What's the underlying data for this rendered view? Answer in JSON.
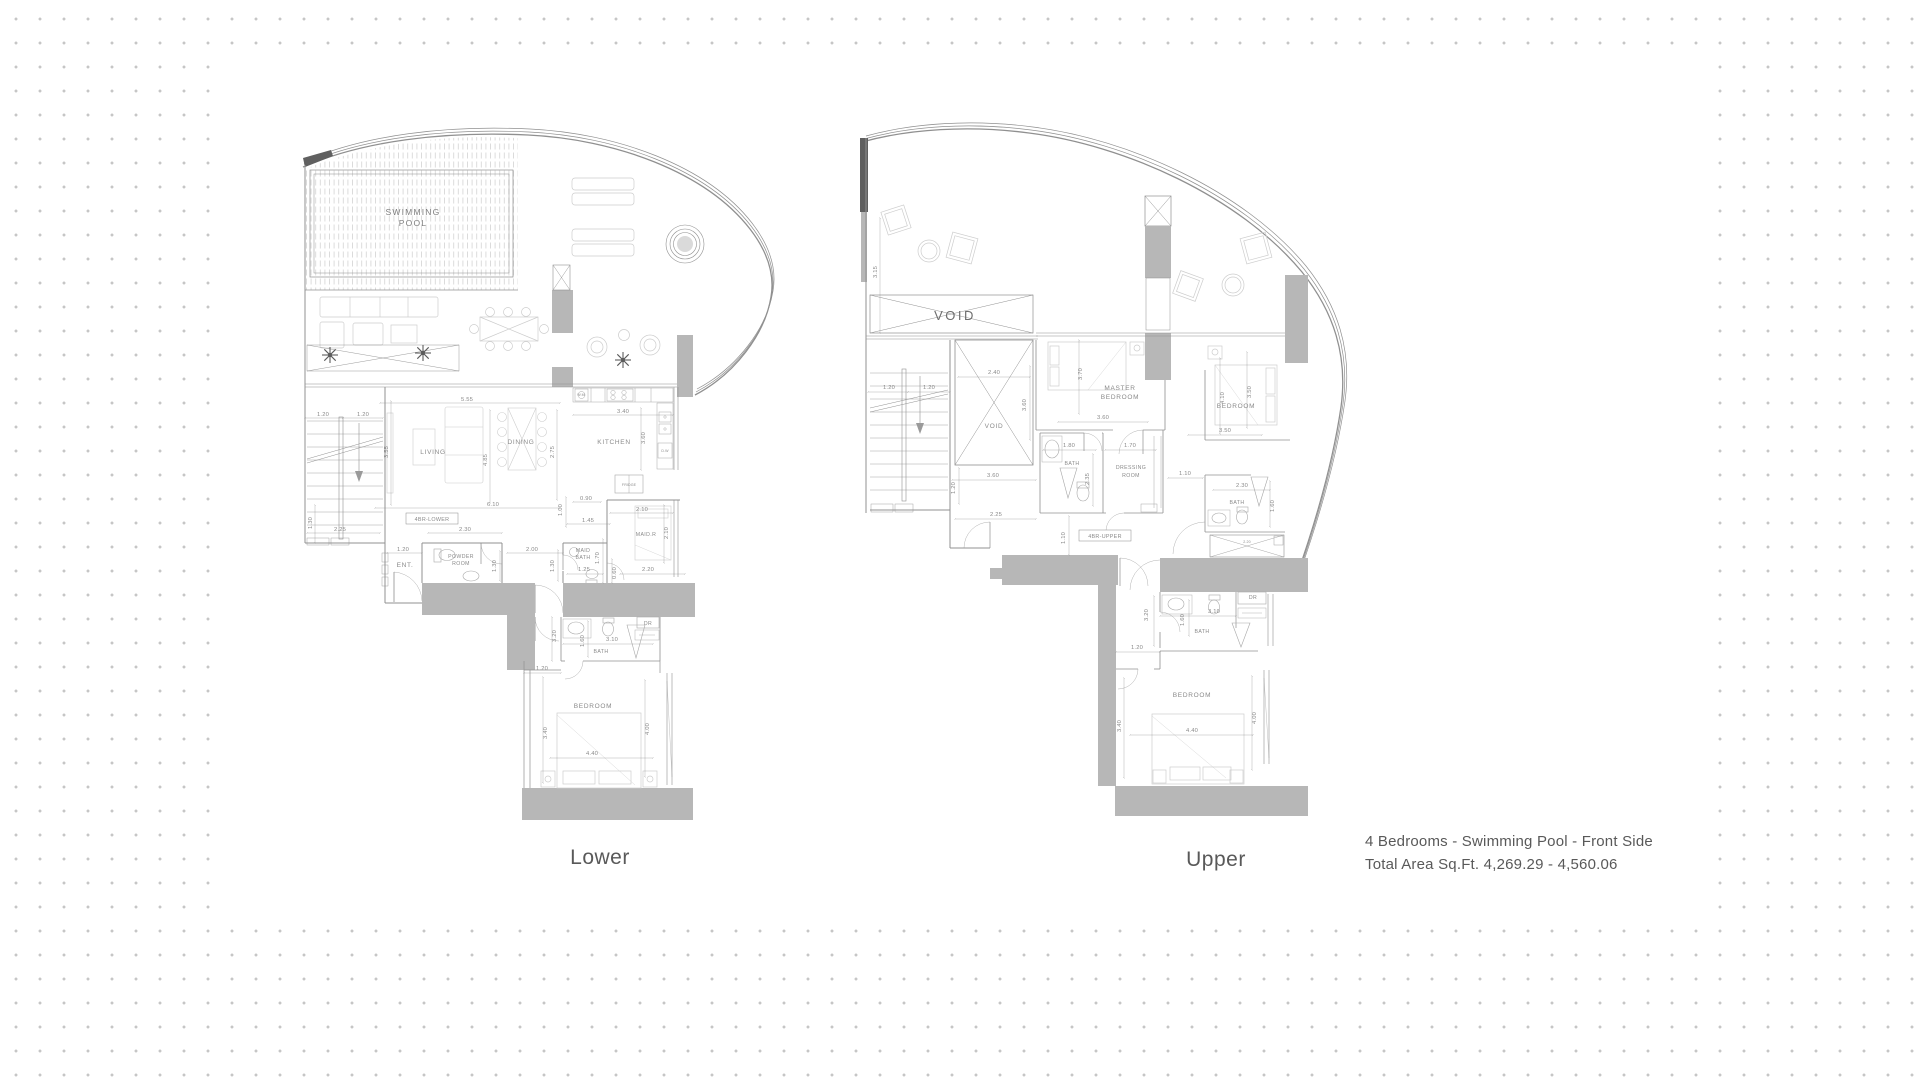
{
  "page": {
    "colors": {
      "wall_fill_gray": "#b7b7b7",
      "dark_wall": "#606060",
      "line_gray": "#909090",
      "label_gray": "#8a8a8a",
      "text_gray": "#595959",
      "background_dot": "#c6c6c6"
    }
  },
  "caption": {
    "line1": "4 Bedrooms - Swimming Pool - Front Side",
    "line2": "Total Area Sq.Ft.  4,269.29 - 4,560.06"
  },
  "plans": {
    "lower": {
      "title": "Lower",
      "labels": [
        {
          "t": "SWIMMING",
          "x": 118,
          "y": 90,
          "c": "pool"
        },
        {
          "t": "POOL",
          "x": 118,
          "y": 101,
          "c": "pool"
        },
        {
          "t": "LIVING",
          "x": 138,
          "y": 329,
          "c": "room"
        },
        {
          "t": "DINING",
          "x": 226,
          "y": 319,
          "c": "room"
        },
        {
          "t": "KITCHEN",
          "x": 319,
          "y": 319,
          "c": "room"
        },
        {
          "t": "ENT.",
          "x": 110,
          "y": 442,
          "c": "room"
        },
        {
          "t": "POWDER",
          "x": 166,
          "y": 433,
          "c": "room-sm"
        },
        {
          "t": "ROOM",
          "x": 166,
          "y": 440,
          "c": "room-sm"
        },
        {
          "t": "MAID",
          "x": 288,
          "y": 427,
          "c": "room-sm"
        },
        {
          "t": "BATH",
          "x": 288,
          "y": 434,
          "c": "room-sm"
        },
        {
          "t": "MAID.R",
          "x": 351,
          "y": 411,
          "c": "room-sm"
        },
        {
          "t": "BATH",
          "x": 306,
          "y": 528,
          "c": "room-sm"
        },
        {
          "t": "BEDROOM",
          "x": 298,
          "y": 583,
          "c": "room"
        },
        {
          "t": "FRIDGE",
          "x": 334,
          "y": 361,
          "c": "tiny"
        },
        {
          "t": "W.M",
          "x": 286,
          "y": 271,
          "c": "tiny"
        },
        {
          "t": "D.W",
          "x": 370,
          "y": 327,
          "c": "tiny"
        },
        {
          "t": "DR",
          "x": 353,
          "y": 500,
          "c": "room-sm"
        },
        {
          "t": "4BR-LOWER",
          "x": 137,
          "y": 396,
          "c": "boxed"
        },
        {
          "t": "5.55",
          "x": 172,
          "y": 276
        },
        {
          "t": "1.20",
          "x": 28,
          "y": 291
        },
        {
          "t": "1.20",
          "x": 68,
          "y": 291
        },
        {
          "t": "3.55",
          "x": 93,
          "y": 327,
          "r": -90
        },
        {
          "t": "4.85",
          "x": 192,
          "y": 335,
          "r": -90
        },
        {
          "t": "2.75",
          "x": 259,
          "y": 327,
          "r": -90
        },
        {
          "t": "3.40",
          "x": 328,
          "y": 288
        },
        {
          "t": "3.60",
          "x": 350,
          "y": 313,
          "r": -90
        },
        {
          "t": "6.10",
          "x": 198,
          "y": 381
        },
        {
          "t": "2.30",
          "x": 170,
          "y": 406
        },
        {
          "t": "2.25",
          "x": 45,
          "y": 406
        },
        {
          "t": "1.30",
          "x": 17,
          "y": 398,
          "r": -90
        },
        {
          "t": "1.20",
          "x": 108,
          "y": 426
        },
        {
          "t": "1.30",
          "x": 201,
          "y": 441,
          "r": -90
        },
        {
          "t": "2.00",
          "x": 237,
          "y": 426
        },
        {
          "t": "1.30",
          "x": 259,
          "y": 441,
          "r": -90
        },
        {
          "t": "0.90",
          "x": 291,
          "y": 375
        },
        {
          "t": "1.00",
          "x": 267,
          "y": 385,
          "r": -90
        },
        {
          "t": "1.45",
          "x": 293,
          "y": 397
        },
        {
          "t": "1.25",
          "x": 289,
          "y": 446
        },
        {
          "t": "1.70",
          "x": 304,
          "y": 433,
          "r": -90
        },
        {
          "t": "2.10",
          "x": 347,
          "y": 386
        },
        {
          "t": "2.10",
          "x": 373,
          "y": 408,
          "r": -90
        },
        {
          "t": "0.60",
          "x": 321,
          "y": 448,
          "r": -90
        },
        {
          "t": "2.20",
          "x": 353,
          "y": 446
        },
        {
          "t": "3.20",
          "x": 261,
          "y": 511,
          "r": -90
        },
        {
          "t": "1.60",
          "x": 289,
          "y": 516,
          "r": -90
        },
        {
          "t": "3.10",
          "x": 317,
          "y": 516
        },
        {
          "t": "1.20",
          "x": 247,
          "y": 545
        },
        {
          "t": "3.40",
          "x": 252,
          "y": 608,
          "r": -90
        },
        {
          "t": "4.40",
          "x": 297,
          "y": 630
        },
        {
          "t": "4.00",
          "x": 354,
          "y": 604,
          "r": -90
        }
      ]
    },
    "upper": {
      "title": "Upper",
      "labels": [
        {
          "t": "VOID",
          "x": 97,
          "y": 202,
          "c": "void-big"
        },
        {
          "t": "VOID",
          "x": 136,
          "y": 310,
          "c": "room"
        },
        {
          "t": "MASTER",
          "x": 262,
          "y": 272,
          "c": "room"
        },
        {
          "t": "BEDROOM",
          "x": 262,
          "y": 281,
          "c": "room"
        },
        {
          "t": "BATH",
          "x": 214,
          "y": 347,
          "c": "room-sm"
        },
        {
          "t": "DRESSING",
          "x": 273,
          "y": 351,
          "c": "room-sm"
        },
        {
          "t": "ROOM",
          "x": 273,
          "y": 359,
          "c": "room-sm"
        },
        {
          "t": "BEDROOM",
          "x": 378,
          "y": 290,
          "c": "room"
        },
        {
          "t": "BATH",
          "x": 379,
          "y": 386,
          "c": "room-sm"
        },
        {
          "t": "BATH",
          "x": 344,
          "y": 515,
          "c": "room-sm"
        },
        {
          "t": "BEDROOM",
          "x": 334,
          "y": 579,
          "c": "room"
        },
        {
          "t": "DR",
          "x": 395,
          "y": 481,
          "c": "room-sm"
        },
        {
          "t": "4BR-UPPER",
          "x": 247,
          "y": 420,
          "c": "boxed"
        },
        {
          "t": "3.15",
          "x": 19,
          "y": 154,
          "r": -90
        },
        {
          "t": "1.20",
          "x": 31,
          "y": 271
        },
        {
          "t": "1.20",
          "x": 71,
          "y": 271
        },
        {
          "t": "2.40",
          "x": 136,
          "y": 256
        },
        {
          "t": "3.60",
          "x": 168,
          "y": 287,
          "r": -90
        },
        {
          "t": "3.70",
          "x": 224,
          "y": 256,
          "r": -90
        },
        {
          "t": "3.60",
          "x": 245,
          "y": 301
        },
        {
          "t": "1.80",
          "x": 211,
          "y": 329
        },
        {
          "t": "1.70",
          "x": 272,
          "y": 329
        },
        {
          "t": "2.35",
          "x": 231,
          "y": 361,
          "r": -90
        },
        {
          "t": "3.60",
          "x": 135,
          "y": 359
        },
        {
          "t": "1.20",
          "x": 97,
          "y": 370,
          "r": -90
        },
        {
          "t": "2.25",
          "x": 138,
          "y": 398
        },
        {
          "t": "1.10",
          "x": 207,
          "y": 420,
          "r": -90
        },
        {
          "t": "4.10",
          "x": 366,
          "y": 280,
          "r": -90
        },
        {
          "t": "3.50",
          "x": 393,
          "y": 274,
          "r": -90
        },
        {
          "t": "3.50",
          "x": 367,
          "y": 314
        },
        {
          "t": "1.10",
          "x": 327,
          "y": 357
        },
        {
          "t": "2.30",
          "x": 384,
          "y": 369
        },
        {
          "t": "1.60",
          "x": 416,
          "y": 388,
          "r": -90
        },
        {
          "t": "3.20",
          "x": 290,
          "y": 497,
          "r": -90
        },
        {
          "t": "1.60",
          "x": 326,
          "y": 502,
          "r": -90
        },
        {
          "t": "3.10",
          "x": 356,
          "y": 495
        },
        {
          "t": "1.20",
          "x": 279,
          "y": 531
        },
        {
          "t": "3.40",
          "x": 263,
          "y": 608,
          "r": -90
        },
        {
          "t": "4.40",
          "x": 334,
          "y": 614
        },
        {
          "t": "4.00",
          "x": 398,
          "y": 600,
          "r": -90
        },
        {
          "t": "2.20",
          "x": 389,
          "y": 425,
          "c": "tiny"
        }
      ]
    }
  }
}
